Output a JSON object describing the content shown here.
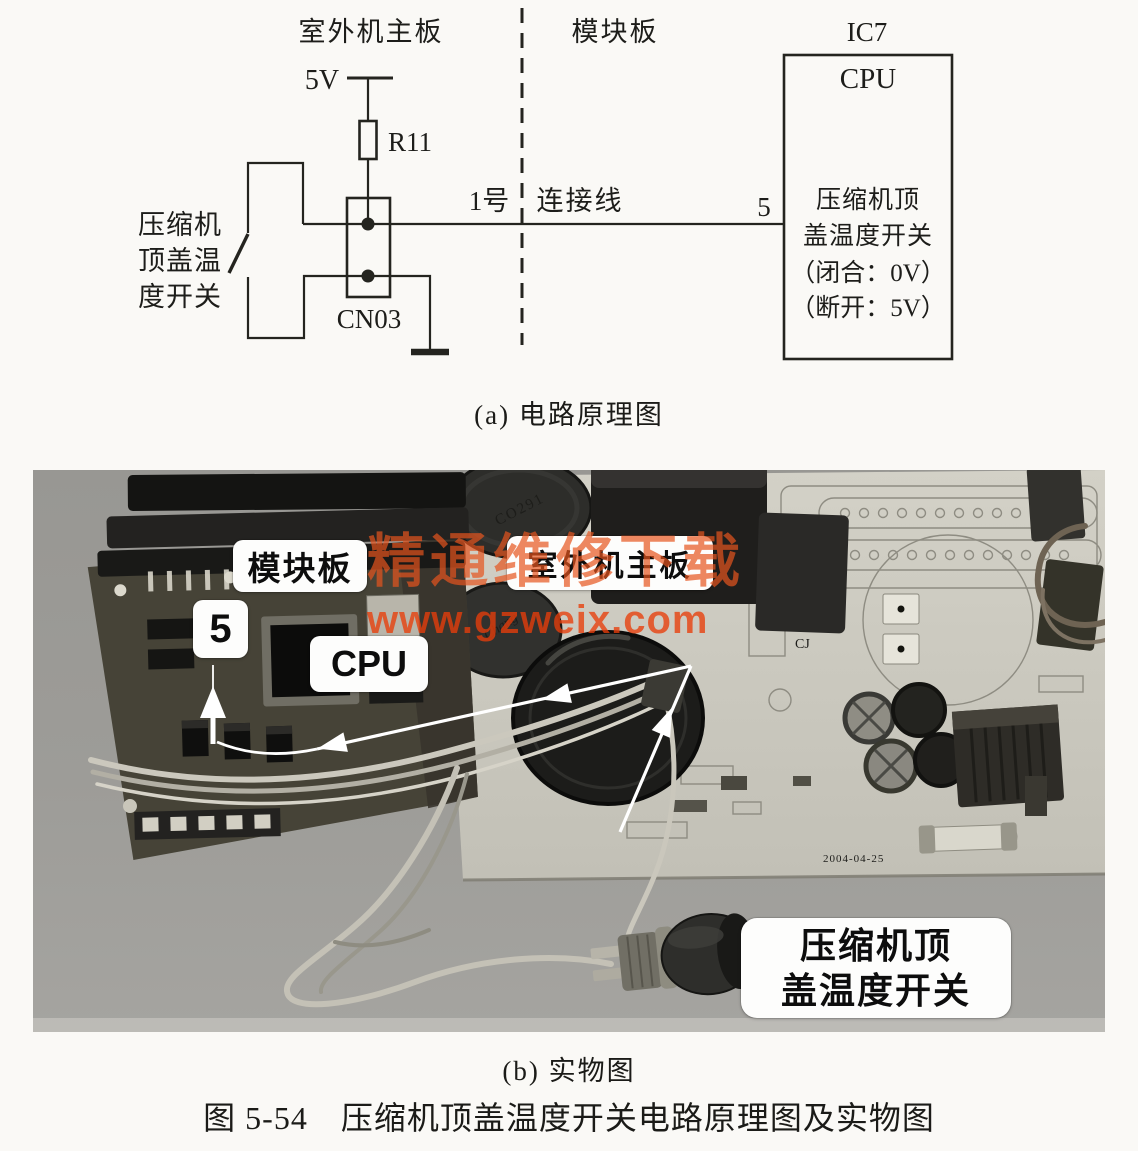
{
  "schematic": {
    "board_left_label": "室外机主板",
    "board_right_label": "模块板",
    "ic_label": "IC7",
    "supply_label": "5V",
    "resistor_label": "R11",
    "connector_label": "CN03",
    "switch_label_lines": [
      "压缩机",
      "顶盖温",
      "度开关"
    ],
    "wire_number_label": "1号",
    "wire_name_label": "连接线",
    "cpu_pin_label": "5",
    "cpu_title": "CPU",
    "cpu_lines": [
      "压缩机顶",
      "盖温度开关",
      "（闭合：0V）",
      "（断开：5V）"
    ],
    "caption": "(a) 电路原理图"
  },
  "photo": {
    "module_board_label": "模块板",
    "main_board_label": "室外机主板",
    "pin_label": "5",
    "cpu_label": "CPU",
    "switch_label_lines": [
      "压缩机顶",
      "盖温度开关"
    ],
    "watermark_line1": "精通维修下载",
    "watermark_line2": "www.gzweix.com",
    "cap_marking_1": "CO291",
    "cap_marking_2": "Chang",
    "silkscreen_cj": "CJ",
    "date_code": "2004-04-25",
    "caption": "(b) 实物图"
  },
  "figure_caption": "图 5-54　压缩机顶盖温度开关电路原理图及实物图",
  "colors": {
    "line": "#24241f",
    "photo_bg": "#9b9a96",
    "module_board": "#464337",
    "main_board": "#c8c6bc",
    "watermark_accent": "#e8551f",
    "annotation": "#ffffff"
  }
}
